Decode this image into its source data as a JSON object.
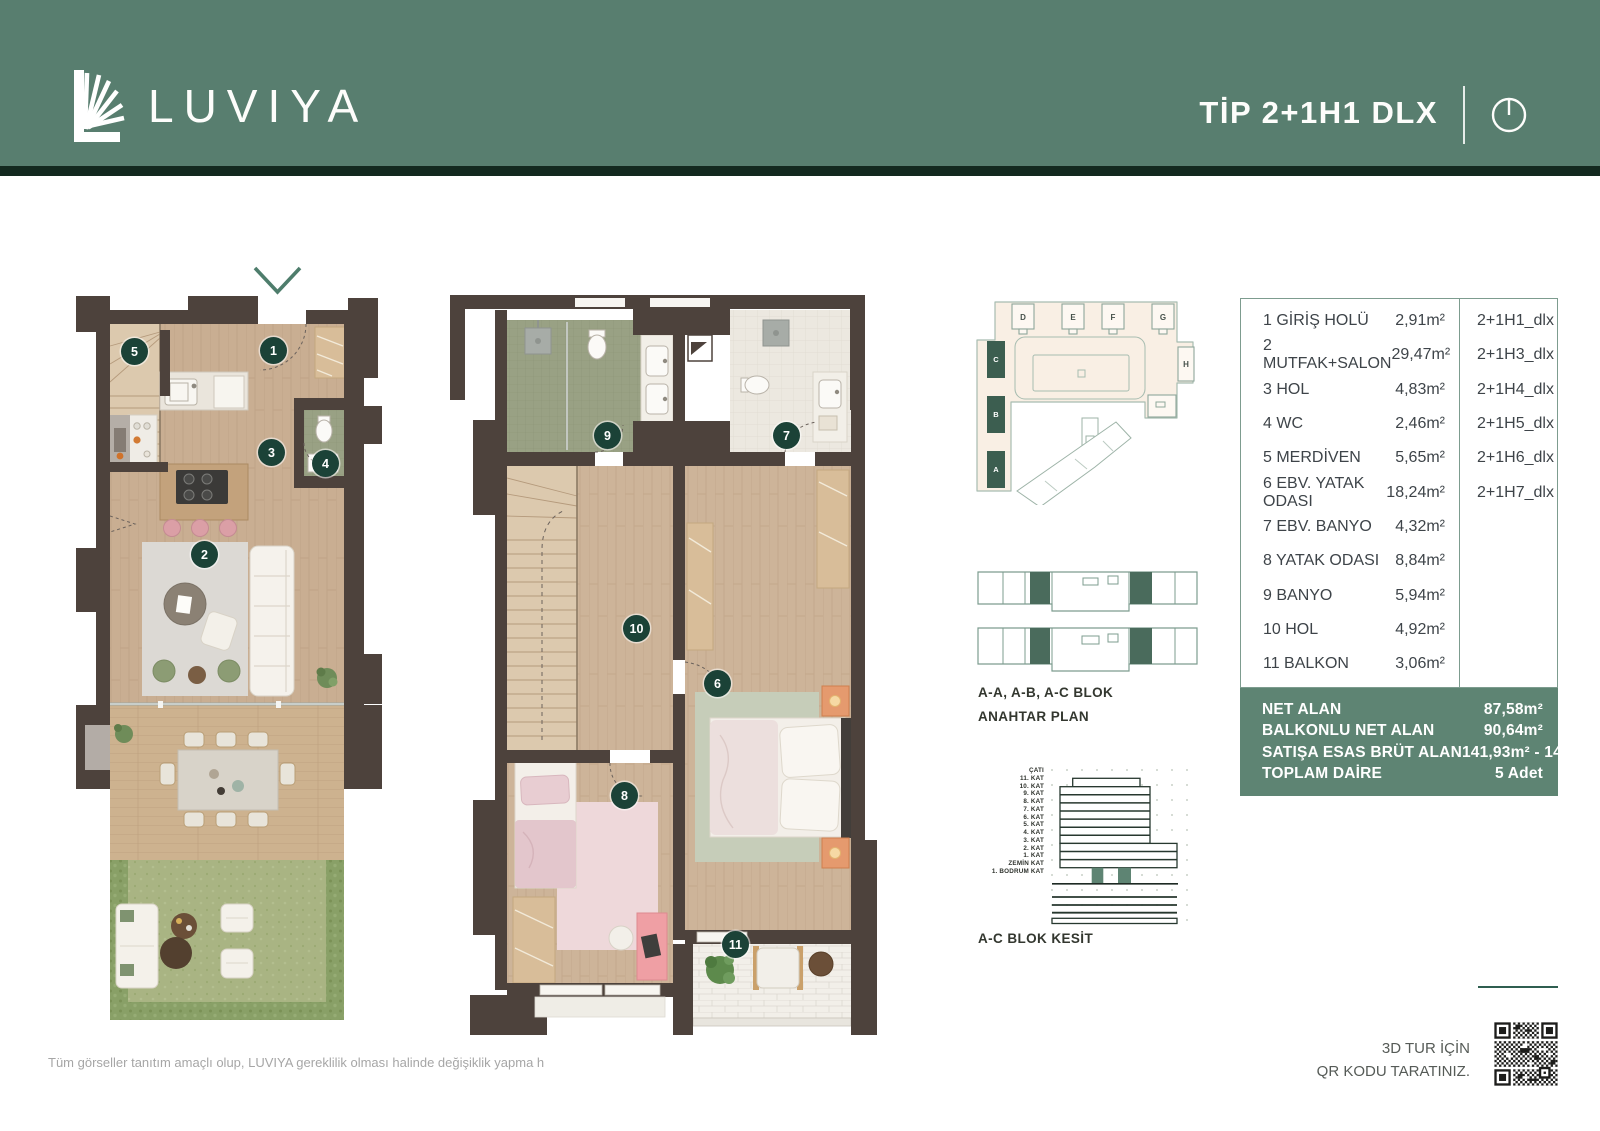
{
  "colors": {
    "header_green": "#587e6f",
    "header_dark_strip": "#13291f",
    "accent_teal": "#7d9c8f",
    "summary_green": "#5e8473",
    "badge_green": "#1b4237",
    "wall_brown": "#4d423c",
    "chevron_green": "#4e7d6c"
  },
  "header": {
    "brand": "LUVIYA",
    "title": "TİP 2+1H1 DLX"
  },
  "rooms": [
    {
      "label": "1 GİRİŞ HOLÜ",
      "area": "2,91m²"
    },
    {
      "label": "2 MUTFAK+SALON",
      "area": "29,47m²"
    },
    {
      "label": "3 HOL",
      "area": "4,83m²"
    },
    {
      "label": "4 WC",
      "area": "2,46m²"
    },
    {
      "label": "5 MERDİVEN",
      "area": "5,65m²"
    },
    {
      "label": "6 EBV. YATAK ODASI",
      "area": "18,24m²"
    },
    {
      "label": "7 EBV. BANYO",
      "area": "4,32m²"
    },
    {
      "label": "8 YATAK ODASI",
      "area": "8,84m²"
    },
    {
      "label": "9 BANYO",
      "area": "5,94m²"
    },
    {
      "label": "10 HOL",
      "area": "4,92m²"
    },
    {
      "label": "11 BALKON",
      "area": "3,06m²"
    }
  ],
  "types": [
    "2+1H1_dlx",
    "2+1H3_dlx",
    "2+1H4_dlx",
    "2+1H5_dlx",
    "2+1H6_dlx",
    "2+1H7_dlx"
  ],
  "summary": [
    {
      "label": "NET ALAN",
      "value": "87,58m²"
    },
    {
      "label": "BALKONLU NET ALAN",
      "value": "90,64m²"
    },
    {
      "label": "SATIŞA ESAS BRÜT ALAN",
      "value": "141,93m² - 146,06m²"
    },
    {
      "label": "TOPLAM DAİRE",
      "value": "5 Adet"
    }
  ],
  "badge_numbers": [
    "5",
    "1",
    "3",
    "4",
    "2",
    "9",
    "7",
    "10",
    "6",
    "8",
    "11"
  ],
  "site": {
    "blocks": [
      "D",
      "E",
      "F",
      "G",
      "H",
      "C",
      "B",
      "A"
    ]
  },
  "key_plan": {
    "line1": "A-A, A-B, A-C BLOK",
    "line2": "ANAHTAR PLAN"
  },
  "section": {
    "label": "A-C BLOK KESİT",
    "floors": [
      "ÇATI",
      "11. KAT",
      "10. KAT",
      "9. KAT",
      "8. KAT",
      "7. KAT",
      "6. KAT",
      "5. KAT",
      "4. KAT",
      "3. KAT",
      "2. KAT",
      "1. KAT",
      "ZEMİN KAT",
      "1. BODRUM KAT"
    ]
  },
  "qr": {
    "line1": "3D TUR İÇİN",
    "line2": "QR KODU TARATINIZ."
  },
  "disclaimer": "Tüm görseller tanıtım amaçlı olup, LUVIYA gereklilik olması halinde değişiklik yapma h"
}
